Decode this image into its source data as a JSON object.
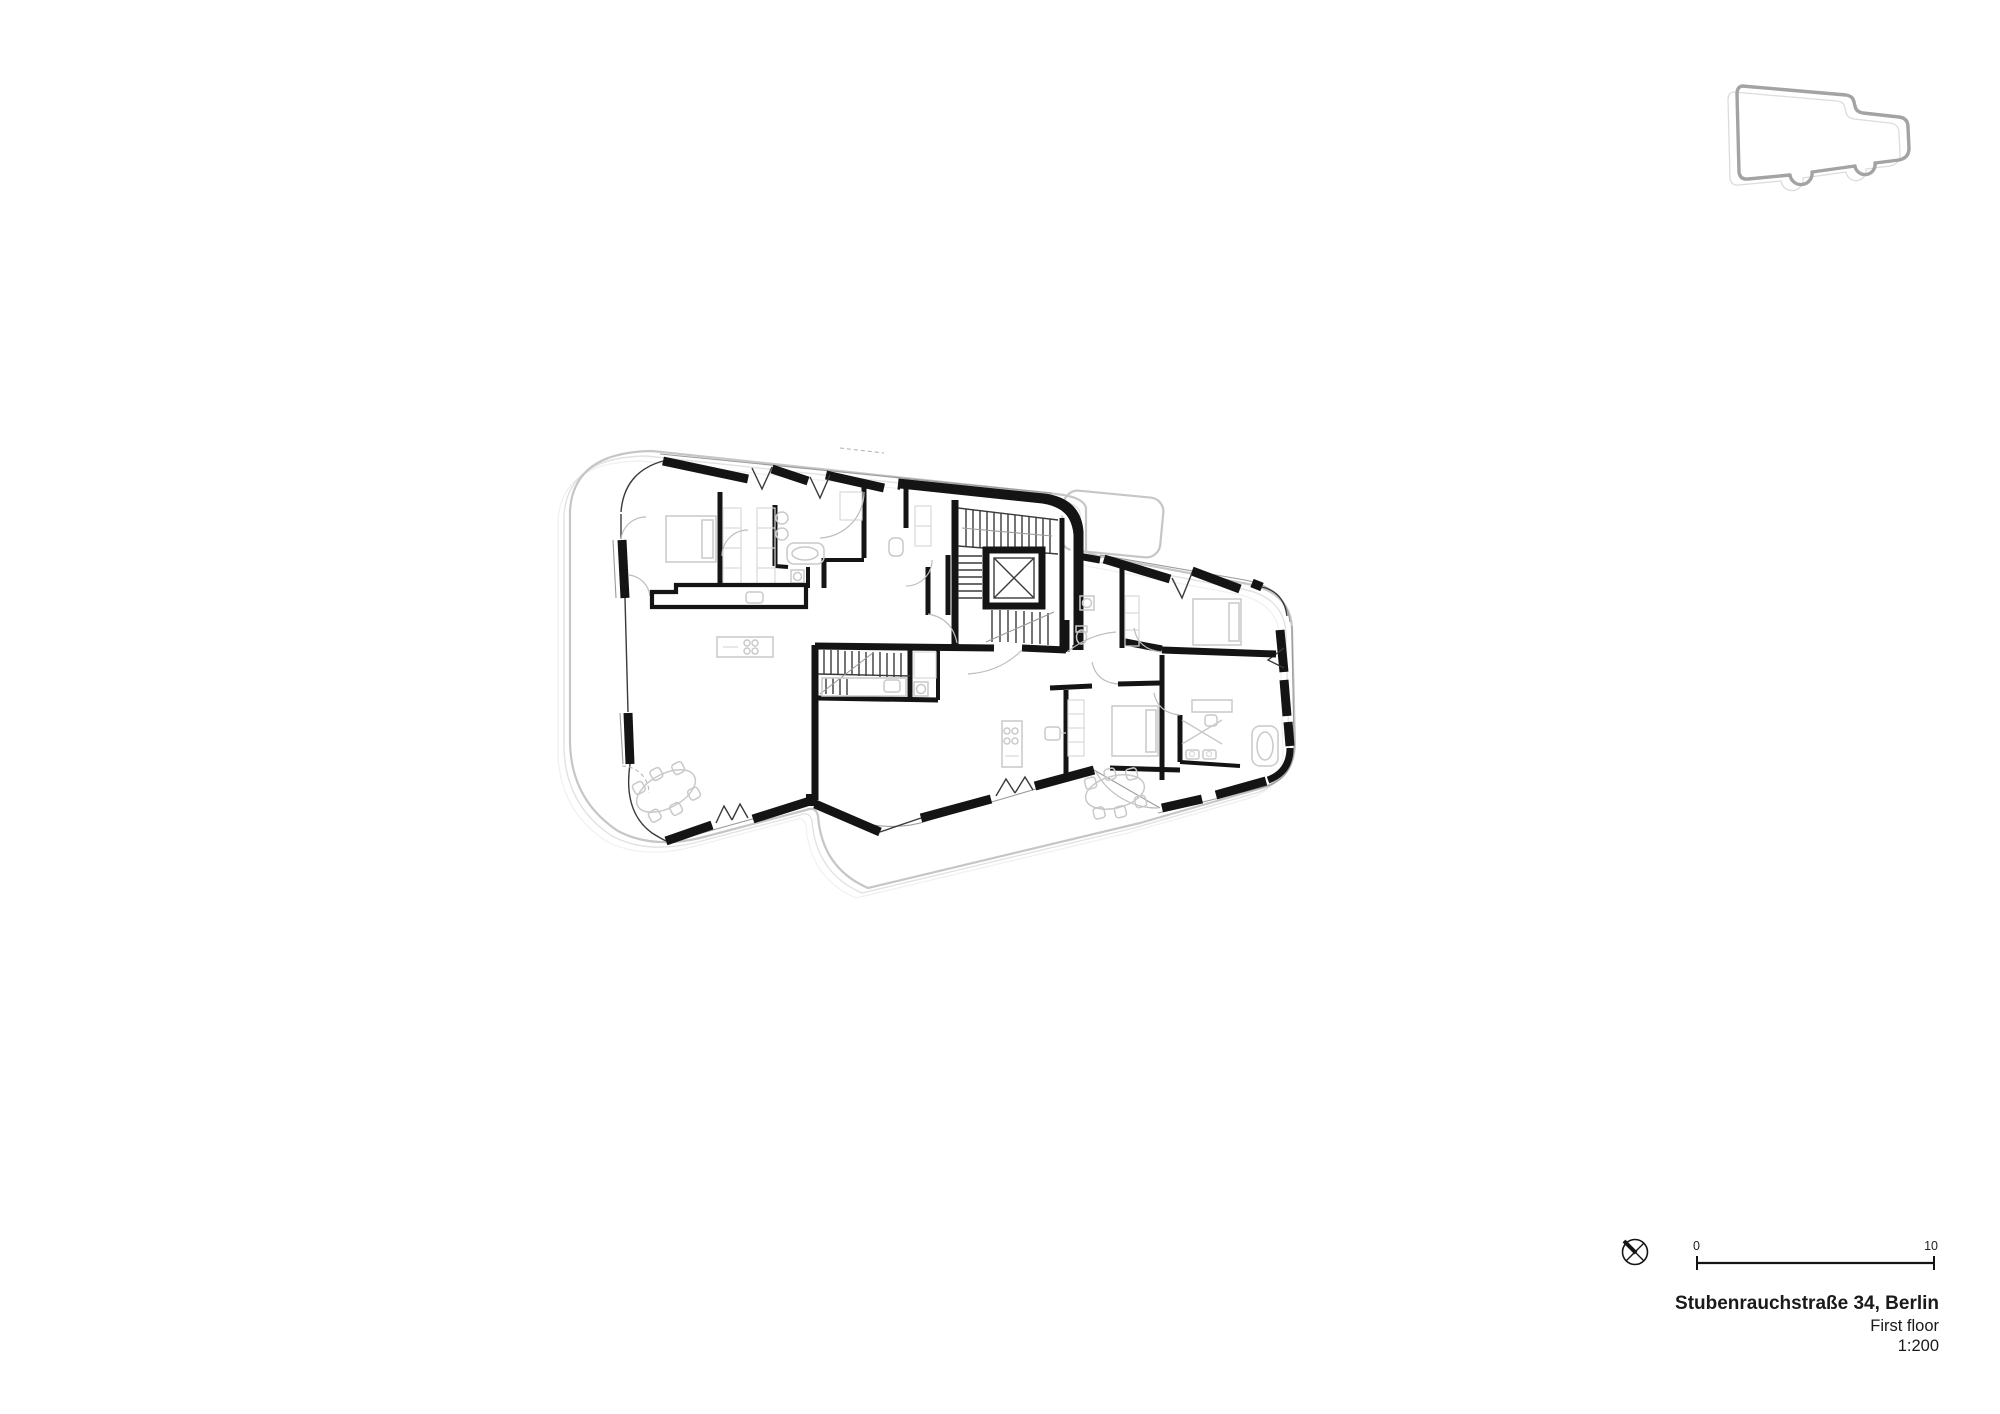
{
  "sheet": {
    "background": "#ffffff"
  },
  "drawing": {
    "kind": "architectural-floor-plan",
    "wall_color": "#141414",
    "site_outline_color": "#c6c6c6",
    "furniture_color": "#c9c9c9",
    "features": [
      "stair-core",
      "elevator",
      "two-dwellings",
      "window-bands",
      "kitchen-islands",
      "dining-tables",
      "bathtubs",
      "beds"
    ]
  },
  "key_plan": {
    "outline_color": "#a3a3a3"
  },
  "scale_bar": {
    "start_label": "0",
    "end_label": "10"
  },
  "title_block": {
    "project": "Stubenrauchstraße 34, Berlin",
    "floor_label": "First floor",
    "scale_label": "1:200"
  }
}
